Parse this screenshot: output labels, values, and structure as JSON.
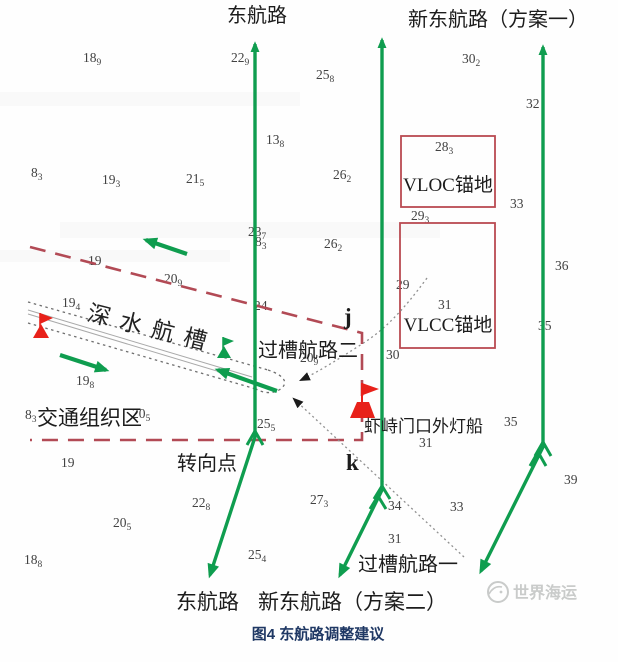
{
  "figure": {
    "caption": "图4 东航路调整建议",
    "watermark": "世界海运"
  },
  "colors": {
    "route_green": "#0f9d4f",
    "boundary_red": "#b24a55",
    "anchorage_red": "#b94a52",
    "symbol_red": "#e8211a",
    "caption_navy": "#1f3864",
    "watermark_gray": "#c9cbca"
  },
  "labels": {
    "east_route_top": "东航路",
    "new_east_route_plan1": "新东航路（方案一）",
    "deep_water_channel": "深水航槽",
    "cross_channel_route_2": "过槽航路二",
    "traffic_organization_zone": "交通组织区",
    "turning_point": "转向点",
    "lightship": "虾峙门口外灯船",
    "cross_channel_route_1": "过槽航路一",
    "east_route_bottom": "东航路",
    "new_east_route_plan2": "新东航路（方案二）",
    "point_j": "j",
    "point_k": "k",
    "vloc_anchorage": "VLOC锚地",
    "vlcc_anchorage": "VLCC锚地"
  },
  "soundings": [
    {
      "x": 83,
      "y": 62,
      "v": "18",
      "s": "9"
    },
    {
      "x": 231,
      "y": 62,
      "v": "22",
      "s": "9"
    },
    {
      "x": 316,
      "y": 79,
      "v": "25",
      "s": "8"
    },
    {
      "x": 462,
      "y": 63,
      "v": "30",
      "s": "2"
    },
    {
      "x": 266,
      "y": 144,
      "v": "13",
      "s": "8"
    },
    {
      "x": 526,
      "y": 108,
      "v": "32",
      "s": ""
    },
    {
      "x": 31,
      "y": 177,
      "v": "8",
      "s": "3"
    },
    {
      "x": 102,
      "y": 184,
      "v": "19",
      "s": "3"
    },
    {
      "x": 186,
      "y": 183,
      "v": "21",
      "s": "5"
    },
    {
      "x": 333,
      "y": 179,
      "v": "26",
      "s": "2"
    },
    {
      "x": 435,
      "y": 151,
      "v": "28",
      "s": "3"
    },
    {
      "x": 510,
      "y": 208,
      "v": "33",
      "s": ""
    },
    {
      "x": 411,
      "y": 220,
      "v": "29",
      "s": "3"
    },
    {
      "x": 324,
      "y": 248,
      "v": "26",
      "s": "2"
    },
    {
      "x": 248,
      "y": 236,
      "v": "23",
      "s": "7"
    },
    {
      "x": 255,
      "y": 246,
      "v": "8",
      "s": "3"
    },
    {
      "x": 88,
      "y": 265,
      "v": "19",
      "s": ""
    },
    {
      "x": 164,
      "y": 283,
      "v": "20",
      "s": "9"
    },
    {
      "x": 62,
      "y": 307,
      "v": "19",
      "s": "4"
    },
    {
      "x": 254,
      "y": 310,
      "v": "24",
      "s": ""
    },
    {
      "x": 555,
      "y": 270,
      "v": "36",
      "s": ""
    },
    {
      "x": 396,
      "y": 289,
      "v": "29",
      "s": ""
    },
    {
      "x": 438,
      "y": 309,
      "v": "31",
      "s": ""
    },
    {
      "x": 538,
      "y": 330,
      "v": "35",
      "s": ""
    },
    {
      "x": 386,
      "y": 359,
      "v": "30",
      "s": ""
    },
    {
      "x": 300,
      "y": 362,
      "v": "20",
      "s": "9"
    },
    {
      "x": 76,
      "y": 385,
      "v": "19",
      "s": "8"
    },
    {
      "x": 25,
      "y": 419,
      "v": "8",
      "s": "3"
    },
    {
      "x": 132,
      "y": 418,
      "v": "20",
      "s": "5"
    },
    {
      "x": 257,
      "y": 428,
      "v": "25",
      "s": "5"
    },
    {
      "x": 504,
      "y": 426,
      "v": "35",
      "s": ""
    },
    {
      "x": 419,
      "y": 447,
      "v": "31",
      "s": ""
    },
    {
      "x": 61,
      "y": 467,
      "v": "19",
      "s": ""
    },
    {
      "x": 192,
      "y": 507,
      "v": "22",
      "s": "8"
    },
    {
      "x": 310,
      "y": 504,
      "v": "27",
      "s": "3"
    },
    {
      "x": 388,
      "y": 510,
      "v": "34",
      "s": ""
    },
    {
      "x": 450,
      "y": 511,
      "v": "33",
      "s": ""
    },
    {
      "x": 564,
      "y": 484,
      "v": "39",
      "s": ""
    },
    {
      "x": 113,
      "y": 527,
      "v": "20",
      "s": "5"
    },
    {
      "x": 388,
      "y": 543,
      "v": "31",
      "s": ""
    },
    {
      "x": 248,
      "y": 559,
      "v": "25",
      "s": "4"
    },
    {
      "x": 24,
      "y": 564,
      "v": "18",
      "s": "8"
    }
  ]
}
